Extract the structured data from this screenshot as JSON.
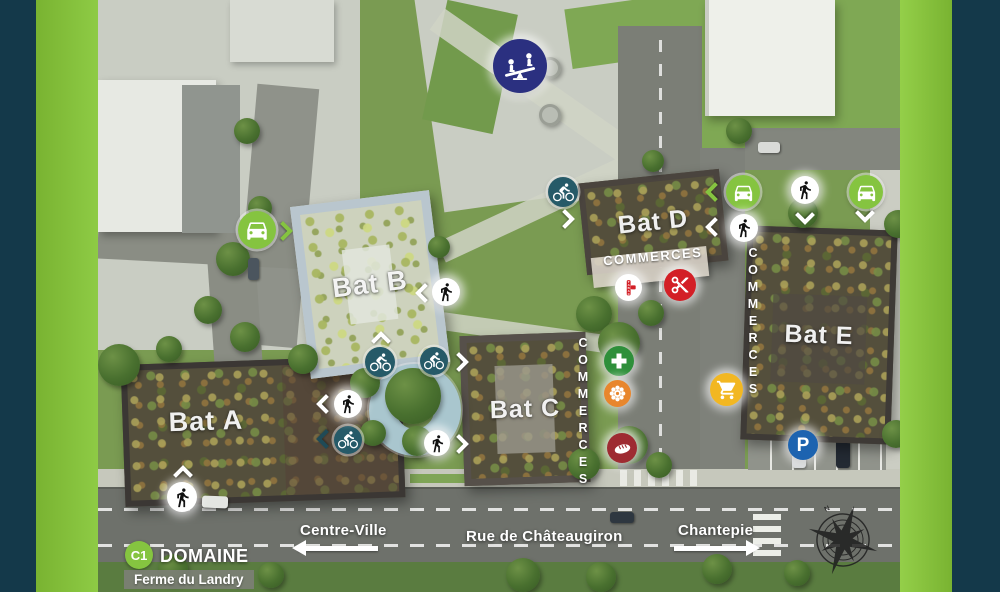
{
  "frame": {
    "background": "#14394A",
    "side_bar_color": "#85C440"
  },
  "project": {
    "code": "C1",
    "title": "DOMAINE",
    "subtitle": "Ferme du Landry"
  },
  "streets": {
    "main": "Rue de Châteaugiron",
    "west": "Centre-Ville",
    "east": "Chantepie"
  },
  "buildings": {
    "a": {
      "label": "Bat A"
    },
    "b": {
      "label": "Bat B"
    },
    "c": {
      "label": "Bat C"
    },
    "d": {
      "label": "Bat D"
    },
    "e": {
      "label": "Bat E"
    }
  },
  "commerces": {
    "bat_d": "COMMERCES",
    "bat_c": "COMMERCES",
    "bat_e": "COMMERCES"
  },
  "icons": {
    "playground": {
      "name": "playground-seesaw-icon",
      "color": "#2B3080"
    },
    "car_access": {
      "name": "car-icon",
      "color": "#85C440"
    },
    "pedestrian_access": {
      "name": "pedestrian-icon",
      "color": "#FFFFFF"
    },
    "bike_access": {
      "name": "bike-icon",
      "color": "#265A68"
    },
    "pharmacy": {
      "name": "pharmacy-cross-icon",
      "color": "#2E8F3A"
    },
    "florist": {
      "name": "flower-icon",
      "color": "#E8862D"
    },
    "bakery": {
      "name": "bread-icon",
      "color": "#9E2B32"
    },
    "tobacco": {
      "name": "tabac-icon",
      "color": "#D31F26",
      "text": "TABAC"
    },
    "hairdresser": {
      "name": "scissors-icon",
      "color": "#D31F26"
    },
    "supermarket": {
      "name": "shopping-cart-icon",
      "color": "#F2B722"
    },
    "parking": {
      "name": "parking-icon",
      "color": "#1D63B0",
      "letter": "P"
    },
    "compass": {
      "name": "compass-rose-icon",
      "color": "#1E1E1E"
    }
  }
}
